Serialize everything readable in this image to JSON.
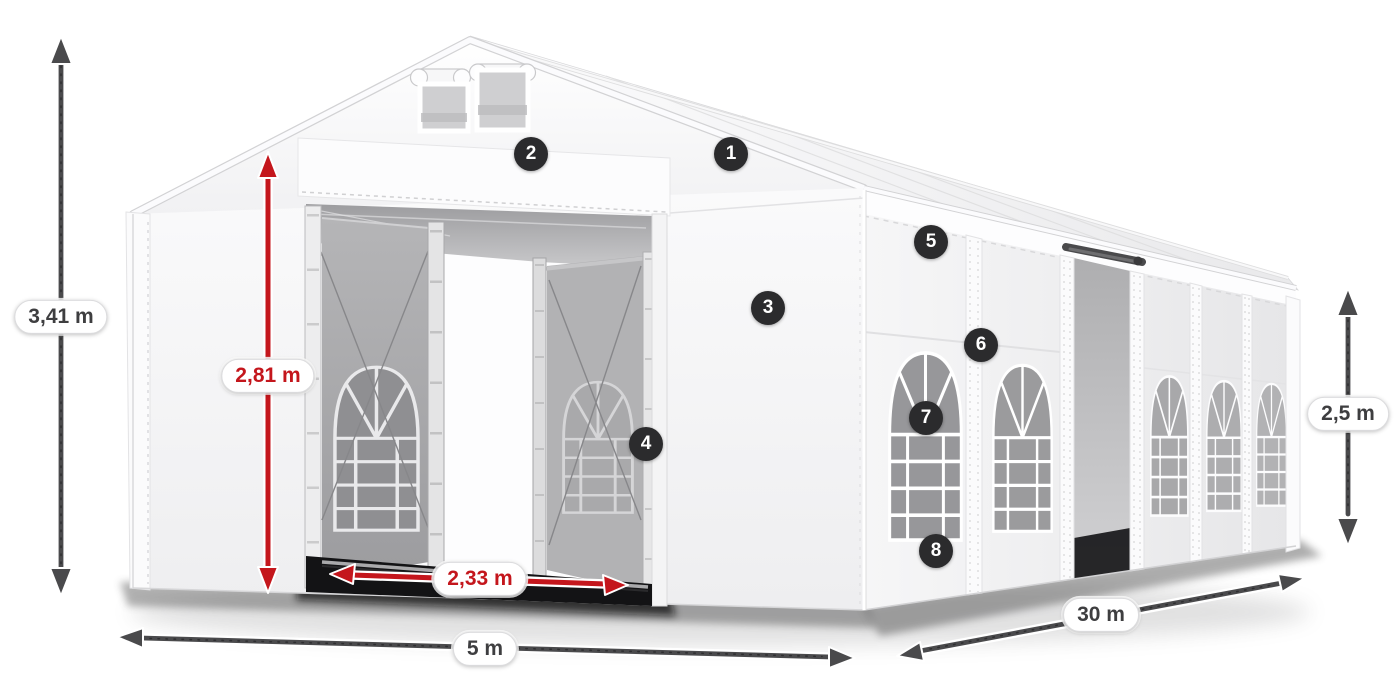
{
  "dimension_labels": {
    "total_height": "3,41 m",
    "entrance_height": "2,81 m",
    "entrance_width": "2,33 m",
    "front_width": "5 m",
    "side_length": "30 m",
    "side_height": "2,5 m"
  },
  "callouts": [
    {
      "number": "1"
    },
    {
      "number": "2"
    },
    {
      "number": "3"
    },
    {
      "number": "4"
    },
    {
      "number": "5"
    },
    {
      "number": "6"
    },
    {
      "number": "7"
    },
    {
      "number": "8"
    }
  ],
  "colors": {
    "dimension_red": "#c4161c",
    "dimension_dark": "#4a4a4c",
    "callout_background": "#2b2b2d",
    "tent_white": "#f7f7f8"
  }
}
